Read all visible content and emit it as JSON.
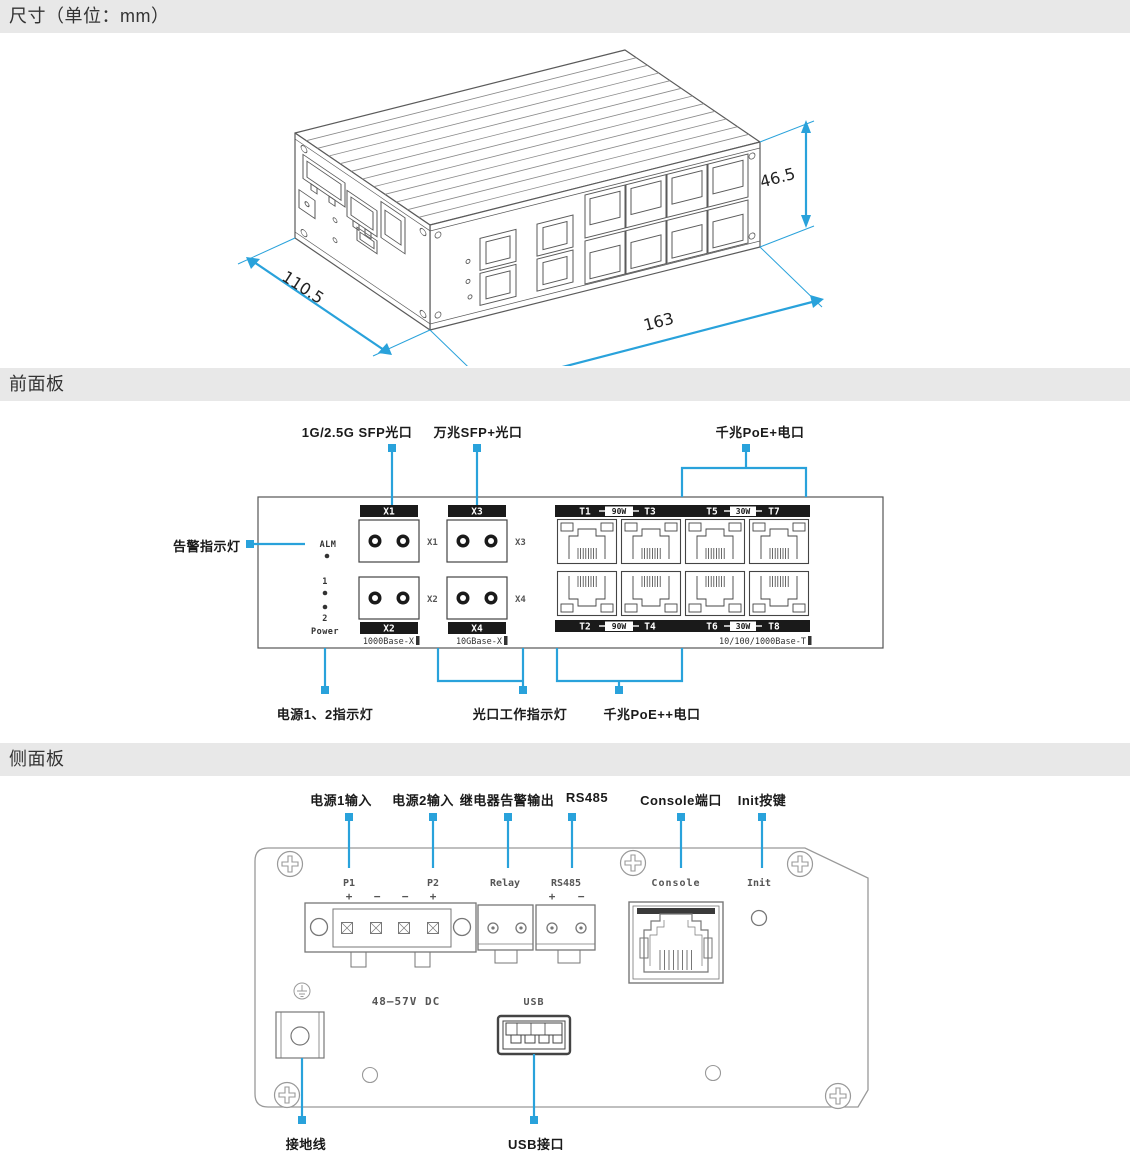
{
  "accent": "#29a2db",
  "sections": {
    "dimensions_title": "尺寸（单位：mm）",
    "front_title": "前面板",
    "side_title": "侧面板"
  },
  "iso": {
    "depth": "110.5",
    "length": "163",
    "height": "46.5"
  },
  "front": {
    "callout_sfp1g": "1G/2.5G SFP光口",
    "callout_sfp10g": "万兆SFP+光口",
    "callout_poe_plus": "千兆PoE+电口",
    "callout_alarm_led": "告警指示灯",
    "callout_power_led": "电源1、2指示灯",
    "callout_fiber_led": "光口工作指示灯",
    "callout_poe_pp": "千兆PoE++电口",
    "led_alm": "ALM",
    "led_1": "1",
    "led_2": "2",
    "led_power": "Power",
    "sfp": [
      "X1",
      "X2",
      "X3",
      "X4"
    ],
    "std_1000": "1000Base-X",
    "std_10g": "10GBase-X",
    "std_t": "10/100/1000Base-T",
    "tbar_tl": [
      "T1",
      "90W",
      "T3"
    ],
    "tbar_tr": [
      "T5",
      "30W",
      "T7"
    ],
    "tbar_bl": [
      "T2",
      "90W",
      "T4"
    ],
    "tbar_br": [
      "T6",
      "30W",
      "T8"
    ]
  },
  "side": {
    "callout_p1": "电源1输入",
    "callout_p2": "电源2输入",
    "callout_relay": "继电器告警输出",
    "callout_rs485": "RS485",
    "callout_console": "Console端口",
    "callout_init": "Init按键",
    "callout_ground": "接地线",
    "callout_usb": "USB接口",
    "p1": "P1",
    "p2": "P2",
    "plus": "+",
    "minus": "−",
    "relay": "Relay",
    "rs485": "RS485",
    "console": "Console",
    "init": "Init",
    "voltage": "48–57V DC",
    "usb": "USB"
  }
}
